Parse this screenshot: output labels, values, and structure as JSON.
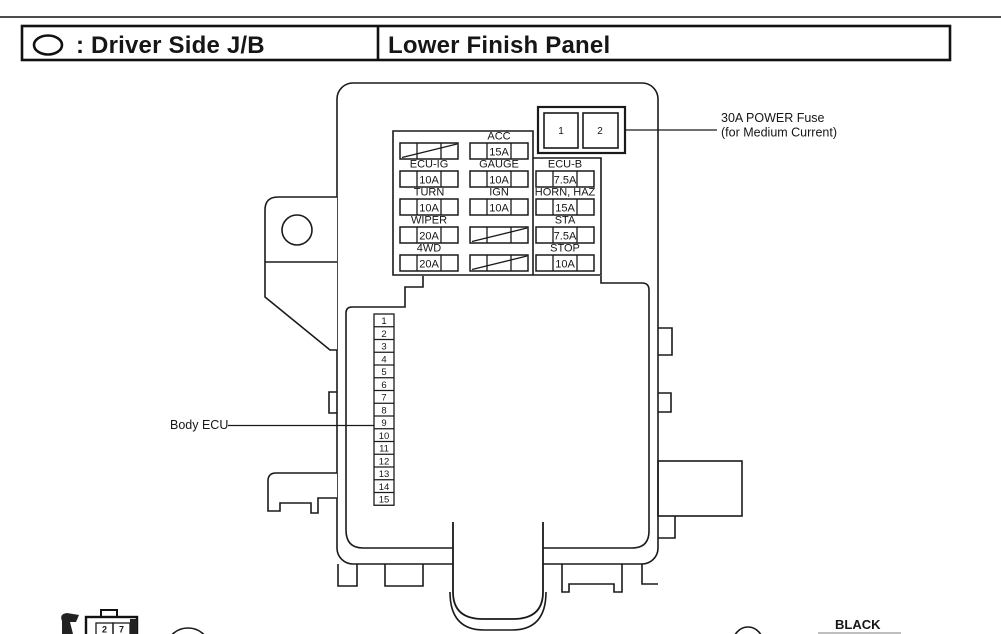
{
  "header": {
    "icon": "oval-junction-block-symbol",
    "left_label": ": Driver Side J/B",
    "right_label": "Lower Finish Panel"
  },
  "colors": {
    "line": "#1a1a1a",
    "background": "#ffffff"
  },
  "power_fuse": {
    "slot1": "1",
    "slot2": "2",
    "note_line1": "30A POWER Fuse",
    "note_line2": "(for Medium Current)"
  },
  "fuses": [
    {
      "column": 1,
      "row": 1,
      "label": "",
      "amps": "",
      "crossed": true
    },
    {
      "column": 2,
      "row": 1,
      "label": "ACC",
      "amps": "15A",
      "crossed": false
    },
    {
      "column": 1,
      "row": 2,
      "label": "ECU-IG",
      "amps": "10A",
      "crossed": false
    },
    {
      "column": 2,
      "row": 2,
      "label": "GAUGE",
      "amps": "10A",
      "crossed": false
    },
    {
      "column": 3,
      "row": 2,
      "label": "ECU-B",
      "amps": "7.5A",
      "crossed": false
    },
    {
      "column": 1,
      "row": 3,
      "label": "TURN",
      "amps": "10A",
      "crossed": false
    },
    {
      "column": 2,
      "row": 3,
      "label": "IGN",
      "amps": "10A",
      "crossed": false
    },
    {
      "column": 3,
      "row": 3,
      "label": "HORN, HAZ",
      "amps": "15A",
      "crossed": false
    },
    {
      "column": 1,
      "row": 4,
      "label": "WIPER",
      "amps": "20A",
      "crossed": false
    },
    {
      "column": 2,
      "row": 4,
      "label": "",
      "amps": "",
      "crossed": true
    },
    {
      "column": 3,
      "row": 4,
      "label": "STA",
      "amps": "7.5A",
      "crossed": false
    },
    {
      "column": 1,
      "row": 5,
      "label": "4WD",
      "amps": "20A",
      "crossed": false
    },
    {
      "column": 2,
      "row": 5,
      "label": "",
      "amps": "",
      "crossed": true
    },
    {
      "column": 3,
      "row": 5,
      "label": "STOP",
      "amps": "10A",
      "crossed": false
    }
  ],
  "body_ecu": {
    "label": "Body ECU",
    "pins": [
      "1",
      "2",
      "3",
      "4",
      "5",
      "6",
      "7",
      "8",
      "9",
      "10",
      "11",
      "12",
      "13",
      "14",
      "15"
    ]
  },
  "footer": {
    "black_label": "BLACK",
    "mini_pins": [
      "2",
      "7"
    ]
  }
}
